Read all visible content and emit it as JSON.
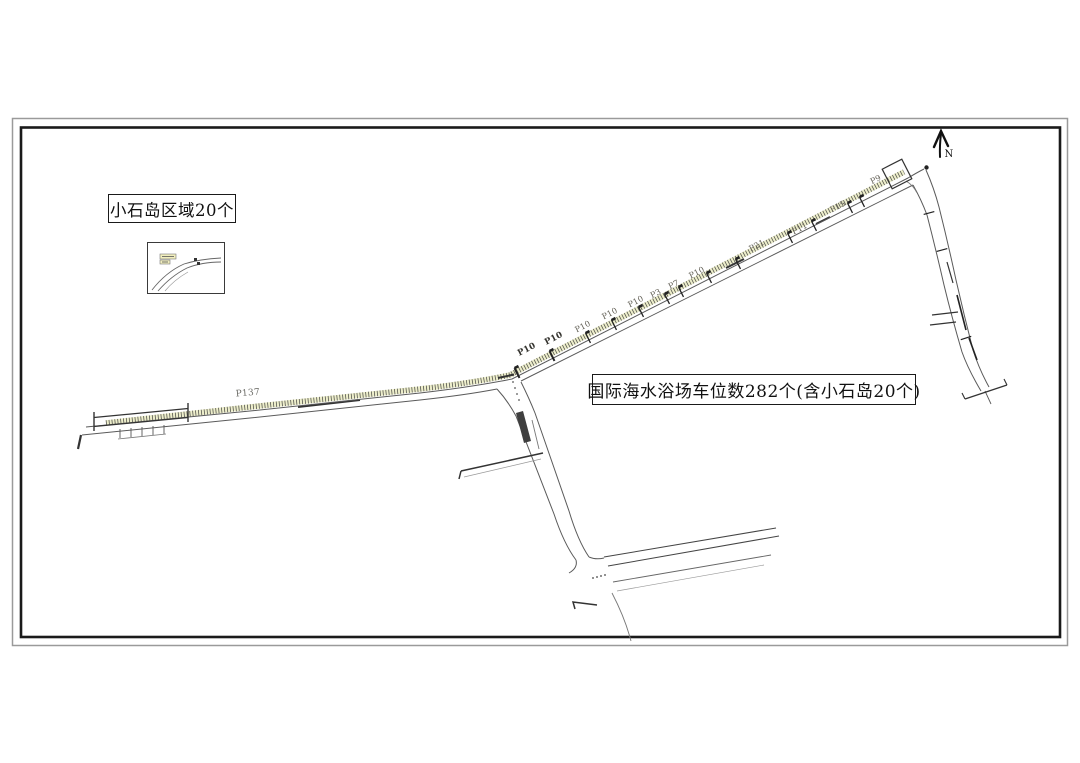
{
  "doc": {
    "type": "parking site plan drawing",
    "area_box_label": "小石岛区域20个",
    "total_box_label": "国际海水浴场车位数282个(含小石岛20个)"
  },
  "north": {
    "label": "N",
    "icon": "north-arrow-icon"
  },
  "colors": {
    "ink": "#1a1a1a",
    "frame_outer": "#9a9a9a",
    "road": "#5a5a5a",
    "band_tint": "#edeecb",
    "band_tick": "#3c3c3c"
  },
  "map": {
    "road_labels": [
      {
        "text": "P137",
        "x": 248,
        "y": 394,
        "a": -5,
        "bold": false,
        "big": true
      },
      {
        "text": "P10",
        "x": 527,
        "y": 350,
        "a": -27,
        "bold": true
      },
      {
        "text": "P10",
        "x": 554,
        "y": 339,
        "a": -27,
        "bold": true
      },
      {
        "text": "P10",
        "x": 583,
        "y": 327,
        "a": -27,
        "bold": false
      },
      {
        "text": "P10",
        "x": 610,
        "y": 314,
        "a": -27,
        "bold": false
      },
      {
        "text": "P10",
        "x": 636,
        "y": 302,
        "a": -27,
        "bold": false
      },
      {
        "text": "P3",
        "x": 656,
        "y": 294,
        "a": -27,
        "bold": false
      },
      {
        "text": "P7",
        "x": 674,
        "y": 285,
        "a": -27,
        "bold": false
      },
      {
        "text": "P10",
        "x": 697,
        "y": 273,
        "a": -27,
        "bold": false
      },
      {
        "text": "P21",
        "x": 757,
        "y": 246,
        "a": -27,
        "bold": false
      },
      {
        "text": "P11",
        "x": 800,
        "y": 229,
        "a": -27,
        "bold": false
      },
      {
        "text": "P15",
        "x": 838,
        "y": 207,
        "a": -27,
        "bold": false
      },
      {
        "text": "P9",
        "x": 876,
        "y": 180,
        "a": -27,
        "bold": false
      }
    ],
    "markers": [
      {
        "x": 517,
        "y": 373,
        "a": -27,
        "w": 2,
        "f": true
      },
      {
        "x": 552,
        "y": 356,
        "a": -27,
        "w": 2,
        "f": true
      },
      {
        "x": 588,
        "y": 338,
        "a": -27,
        "w": 1.3,
        "f": true
      },
      {
        "x": 614,
        "y": 325,
        "a": -27,
        "w": 1.3,
        "f": true
      },
      {
        "x": 641,
        "y": 312,
        "a": -27,
        "w": 1.3,
        "f": true
      },
      {
        "x": 667,
        "y": 299,
        "a": -27,
        "w": 1.3,
        "f": true
      },
      {
        "x": 681,
        "y": 292,
        "a": -27,
        "w": 1.3,
        "f": true
      },
      {
        "x": 709,
        "y": 278,
        "a": -27,
        "w": 1.3,
        "f": true
      },
      {
        "x": 738,
        "y": 264,
        "a": -27,
        "w": 1.3,
        "f": true
      },
      {
        "x": 790,
        "y": 238,
        "a": -27,
        "w": 1.3,
        "f": true
      },
      {
        "x": 814,
        "y": 226,
        "a": -27,
        "w": 1.3,
        "f": true
      },
      {
        "x": 850,
        "y": 208,
        "a": -27,
        "w": 1.3,
        "f": true
      },
      {
        "x": 862,
        "y": 202,
        "a": -27,
        "w": 1.3,
        "f": true
      },
      {
        "x": 929,
        "y": 213,
        "a": 75,
        "w": 1.2,
        "f": false
      },
      {
        "x": 942,
        "y": 250,
        "a": 75,
        "w": 1.2,
        "f": false
      },
      {
        "x": 966,
        "y": 338,
        "a": 72,
        "w": 1.2,
        "f": false
      }
    ]
  }
}
